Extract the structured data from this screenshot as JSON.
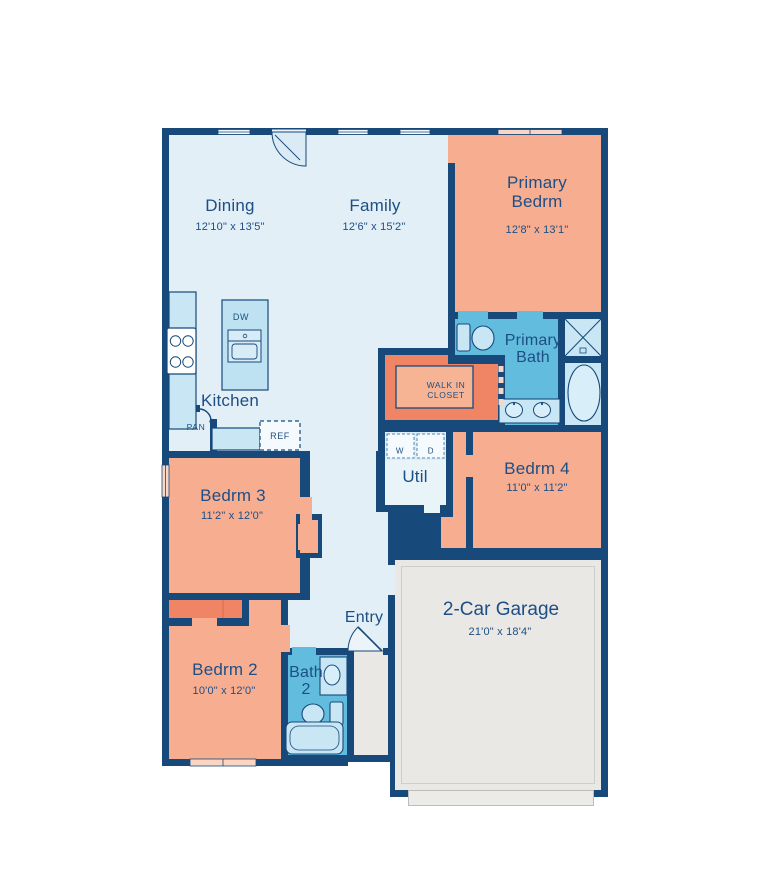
{
  "plan": {
    "type": "single-story floor plan",
    "rooms": {
      "dining": {
        "label": "Dining",
        "dims": "12'10\" x 13'5\""
      },
      "family": {
        "label": "Family",
        "dims": "12'6\" x 15'2\""
      },
      "primary_bedroom": {
        "label": "Primary Bedrm",
        "dims": "12'8\" x 13'1\""
      },
      "primary_bath": {
        "label": "Primary Bath"
      },
      "walk_in_closet": {
        "label": "WALK IN CLOSET"
      },
      "kitchen": {
        "label": "Kitchen"
      },
      "utility": {
        "label": "Util"
      },
      "bedroom4": {
        "label": "Bedrm 4",
        "dims": "11'0\" x 11'2\""
      },
      "bedroom3": {
        "label": "Bedrm 3",
        "dims": "11'2\" x 12'0\""
      },
      "bedroom2": {
        "label": "Bedrm 2",
        "dims": "10'0\" x 12'0\""
      },
      "bath2": {
        "label": "Bath 2"
      },
      "entry": {
        "label": "Entry"
      },
      "garage": {
        "label": "2-Car Garage",
        "dims": "21'0\" x 18'4\""
      }
    },
    "appliances": {
      "dishwasher": "DW",
      "pantry": "PAN",
      "refrigerator": "REF",
      "washer": "W",
      "dryer": "D"
    },
    "palette": {
      "wall_navy": "#17497B",
      "label_text": "#1D4E85",
      "living_floor": "#E2EFF7",
      "bedroom_floor": "#F7AE90",
      "closet_accent": "#EF8565",
      "bath_floor": "#62BCDE",
      "utility_floor": "#E9F4F9",
      "fixture_fill": "#C9E6F4",
      "garage_floor": "#E9E8E4",
      "window_light": "#FBD5C4"
    }
  }
}
